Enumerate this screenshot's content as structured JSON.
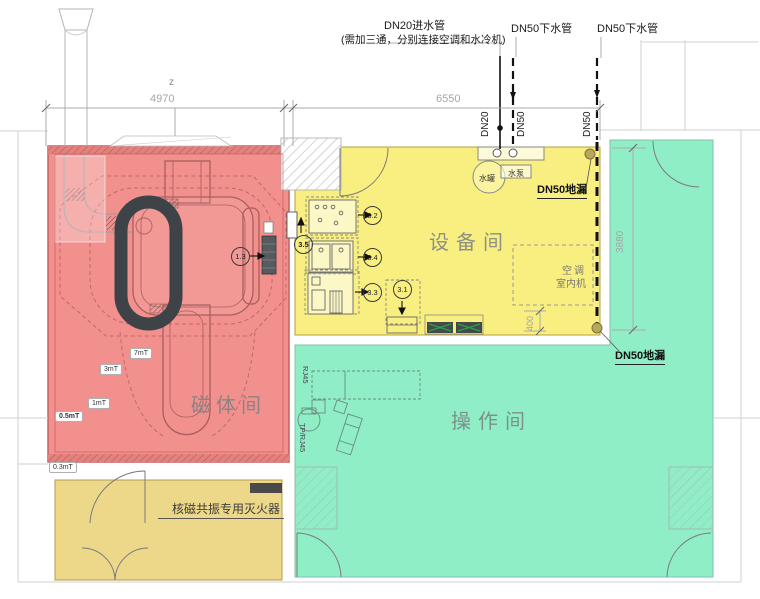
{
  "colors": {
    "magnet": "#f1908d",
    "equipment": "#f9ef80",
    "operation": "#90eec7",
    "extinguisher": "#edd88a"
  },
  "top": {
    "inlet": "DN20进水管",
    "inlet_note": "(需加三通，分别连接空调和水冷机)",
    "drain1": "DN50下水管",
    "drain2": "DN50下水管"
  },
  "tags": {
    "dn20": "DN20",
    "dn50a": "DN50",
    "dn50b": "DN50"
  },
  "dims": {
    "z": "z",
    "w_magnet": "4970",
    "w_equipment": "6550",
    "h_operation": "3880",
    "gap": "400"
  },
  "rooms": {
    "magnet": "磁体间",
    "equipment": "设备间",
    "operation": "操作间",
    "extinguisher": "核磁共振专用灭火器"
  },
  "drains": {
    "top": "DN50地漏",
    "bottom": "DN50地漏"
  },
  "equipment": {
    "tank": "水罐",
    "pump": "水泵",
    "ac_line1": "空调",
    "ac_line2": "室内机"
  },
  "callouts": {
    "c13": "1.3",
    "c35": "3.5",
    "c32": "3.2",
    "c34": "3.4",
    "c33": "3.3",
    "c31": "3.1"
  },
  "field_lines": {
    "f7": "7mT",
    "f3": "3mT",
    "f1": "1mT",
    "f05": "0.5mT",
    "f03": "0.3mT"
  },
  "ports": {
    "rj45": "RJ45",
    "tp_rj45": "TP/RJ45"
  }
}
